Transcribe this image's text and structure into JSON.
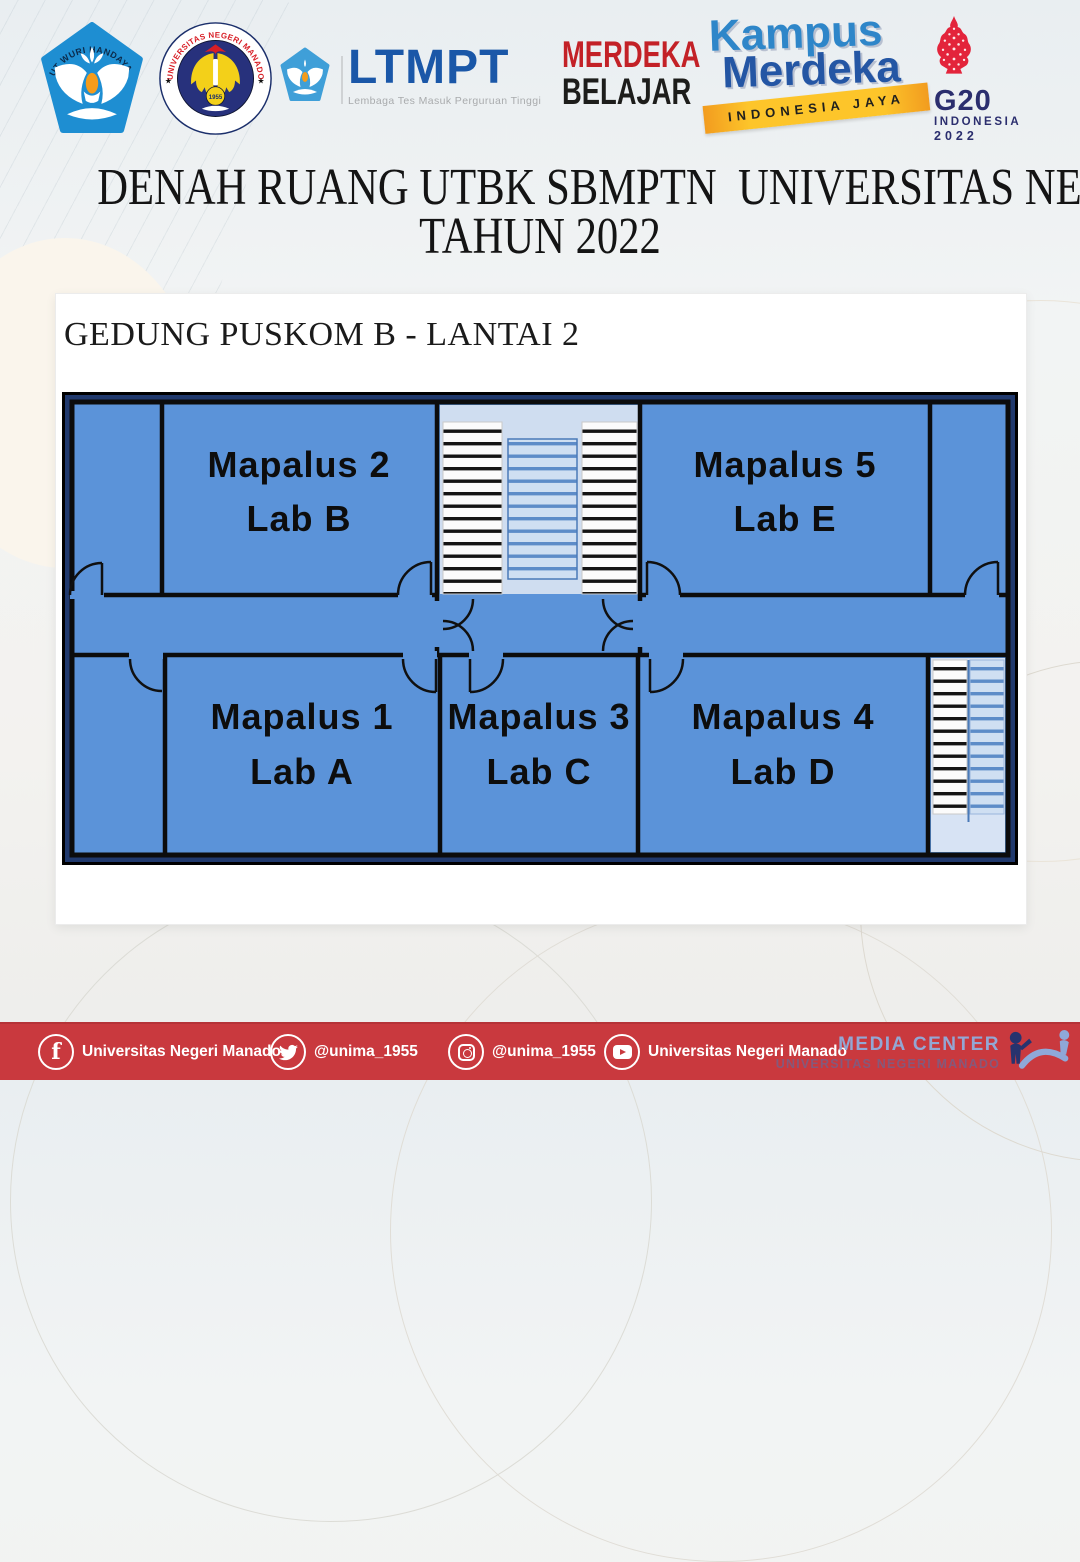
{
  "poster": {
    "title_line1": "DENAH RUANG UTBK SBMPTN  UNIVERSITAS NEGERI MANADO",
    "title_line2": "TAHUN 2022"
  },
  "plan": {
    "heading": "GEDUNG PUSKOM B - LANTAI 2",
    "rooms": [
      {
        "name": "Mapalus 2",
        "lab": "Lab B"
      },
      {
        "name": "Mapalus 5",
        "lab": "Lab E"
      },
      {
        "name": "Mapalus 1",
        "lab": "Lab A"
      },
      {
        "name": "Mapalus 3",
        "lab": "Lab C"
      },
      {
        "name": "Mapalus 4",
        "lab": "Lab D"
      }
    ],
    "colors": {
      "room_fill": "#5b93d9",
      "outer_border": "#20396d",
      "wall": "#0c0c0c",
      "stairwell_light": "#cfddf0"
    }
  },
  "logos": {
    "tutwuri": {
      "label": "TUT WURI HANDAYANI"
    },
    "unima": {
      "arc_top": "UNIVERSITAS NEGERI MANADO",
      "arc_bottom": "UNIMA TONDANO",
      "year": "1955"
    },
    "ltmpt": {
      "name": "LTMPT",
      "subtitle": "Lembaga Tes Masuk Perguruan Tinggi"
    },
    "merdeka_belajar": {
      "line1": "MERDEKA",
      "line2": "BELAJAR"
    },
    "kampus_merdeka": {
      "word1": "Kampus",
      "word2": "Merdeka",
      "ribbon": "INDONESIA JAYA"
    },
    "g20": {
      "name": "G20",
      "country": "INDONESIA",
      "year": "2022"
    }
  },
  "footer": {
    "facebook_label": "Universitas Negeri Manado",
    "twitter_label": "@unima_1955",
    "instagram_label": "@unima_1955",
    "youtube_label": "Universitas Negeri Manado",
    "media_center_line1": "MEDIA CENTER",
    "media_center_line2": "UNIVERSITAS NEGERI MANADO",
    "bar_color": "#c9393e"
  }
}
